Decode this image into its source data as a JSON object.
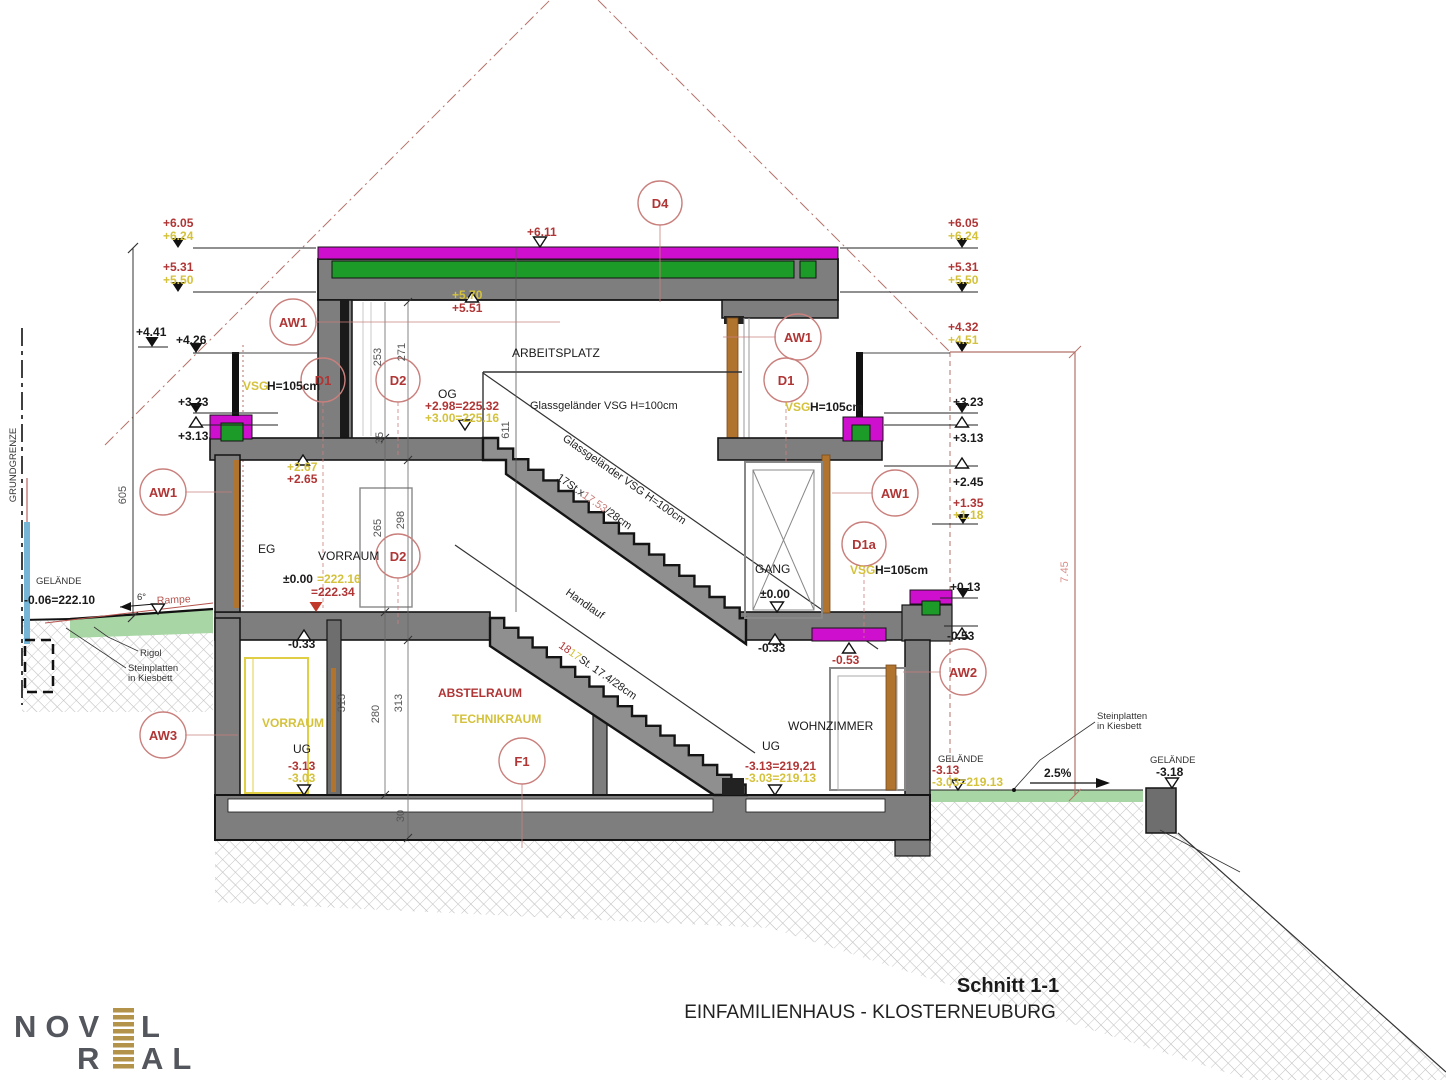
{
  "page": {
    "background": "#ffffff"
  },
  "title_block": {
    "title": "Schnitt 1-1",
    "subtitle": "EINFAMILIENHAUS - KLOSTERNEUBURG"
  },
  "logo": {
    "line1_prefix": "NOV",
    "line1_suffix": "L",
    "line2_prefix": "R",
    "line2_suffix": "AL"
  },
  "colors": {
    "magenta": "#ce0fce",
    "insulation_green": "#1d9b28",
    "terrain_green": "#a8d6a4",
    "wall_gray": "#7e7e7e",
    "wood_brown": "#b1742f",
    "annotation_red": "#b03535",
    "annotation_yellow": "#d4c23c",
    "envelope_red": "#b5726a",
    "logo_gray": "#53565c",
    "logo_gold": "#b3924a"
  },
  "rooms": {
    "arbeitsplatz": "ARBEITSPLATZ",
    "og": "OG",
    "eg": "EG",
    "vorraum_eg": "VORRAUM",
    "gang": "GANG",
    "ug_left": "UG",
    "vorraum_ug": "VORRAUM",
    "abstellraum": "ABSTELRAUM",
    "technikraum": "TECHNIKRAUM",
    "wohnzimmer": "WOHNZIMMER",
    "ug_right": "UG"
  },
  "levels_left": {
    "p605": "+6.05",
    "p624": "+6.24",
    "p531": "+5.31",
    "p550": "+5.50",
    "p441": "+4.41",
    "p426": "+4.26",
    "p323": "+3.23",
    "p313": "+3.13"
  },
  "levels_right": {
    "p605": "+6.05",
    "p624": "+6.24",
    "p531": "+5.31",
    "p550": "+5.50",
    "p432": "+4.32",
    "p451": "+4.51",
    "p323": "+3.23",
    "p313": "+3.13",
    "p245": "+2.45",
    "p135": "+1.35",
    "p118": "+1.18",
    "p013": "+0.13",
    "m053": "-0.53"
  },
  "levels_mid": {
    "roof_top": "+6.11",
    "roof_under_y": "+5.70",
    "roof_under_r": "+5.51",
    "og_r": "+2.98=225.32",
    "og_y": "+3.00=225.16",
    "eg_lintel_y": "+2.67",
    "eg_lintel_r": "+2.65",
    "eg_zero": "±0.00",
    "eg_zero_y": "=222.16",
    "eg_zero_r": "=222.34",
    "eg_m033": "-0.33",
    "gang_zero": "±0.00",
    "gang_m033": "-0.33",
    "gang_m053": "-0.53",
    "ug_r": "-3.13",
    "ug_y": "-3.03",
    "ug_right_r": "-3.13=219,21",
    "ug_right_y": "-3.03=219.13"
  },
  "terrain": {
    "grundgrenze": "GRUNDGRENZE",
    "gelaende_left_label": "GELÄNDE",
    "gelaende_left_value": "-0.06=222.10",
    "ramp_angle": "6°",
    "ramp_label": "Rampe",
    "rigol": "Rigol",
    "stein_left_1": "Steinplatten",
    "stein_left_2": "in Kiesbett",
    "gelaende_right_label": "GELÄNDE",
    "gelaende_right_r": "-3.13",
    "gelaende_right_y": "-3.03=219.13",
    "slope": "2.5%",
    "stein_right_1": "Steinplatten",
    "stein_right_2": "in Kiesbett",
    "gelaende_far_label": "GELÄNDE",
    "gelaende_far_value": "-3.18"
  },
  "railings": {
    "vsg": "VSG",
    "h105": "H=105cm",
    "glass_og": "Glassgeländer VSG H=100cm",
    "glass_stair": "Glassgeländer VSG H=100cm",
    "stair_up_pre": "17St.x",
    "stair_up_riser": "17.53",
    "stair_up_post": "/28cm",
    "handlauf": "Handlauf",
    "stair_dn_red": "18",
    "stair_dn_yellow": "17",
    "stair_dn_post": "St. 17.4/28cm"
  },
  "dims": {
    "d605": "605",
    "d611": "611",
    "d253": "253",
    "d271": "271",
    "d265": "265",
    "d298": "298",
    "d313a": "313",
    "d280": "280",
    "d313b": "313",
    "d30": "30",
    "d35": "35",
    "d745": "7.45"
  },
  "tags": {
    "aw1": "AW1",
    "aw2": "AW2",
    "aw3": "AW3",
    "d1": "D1",
    "d1a": "D1a",
    "d2": "D2",
    "d4": "D4",
    "f1": "F1"
  }
}
